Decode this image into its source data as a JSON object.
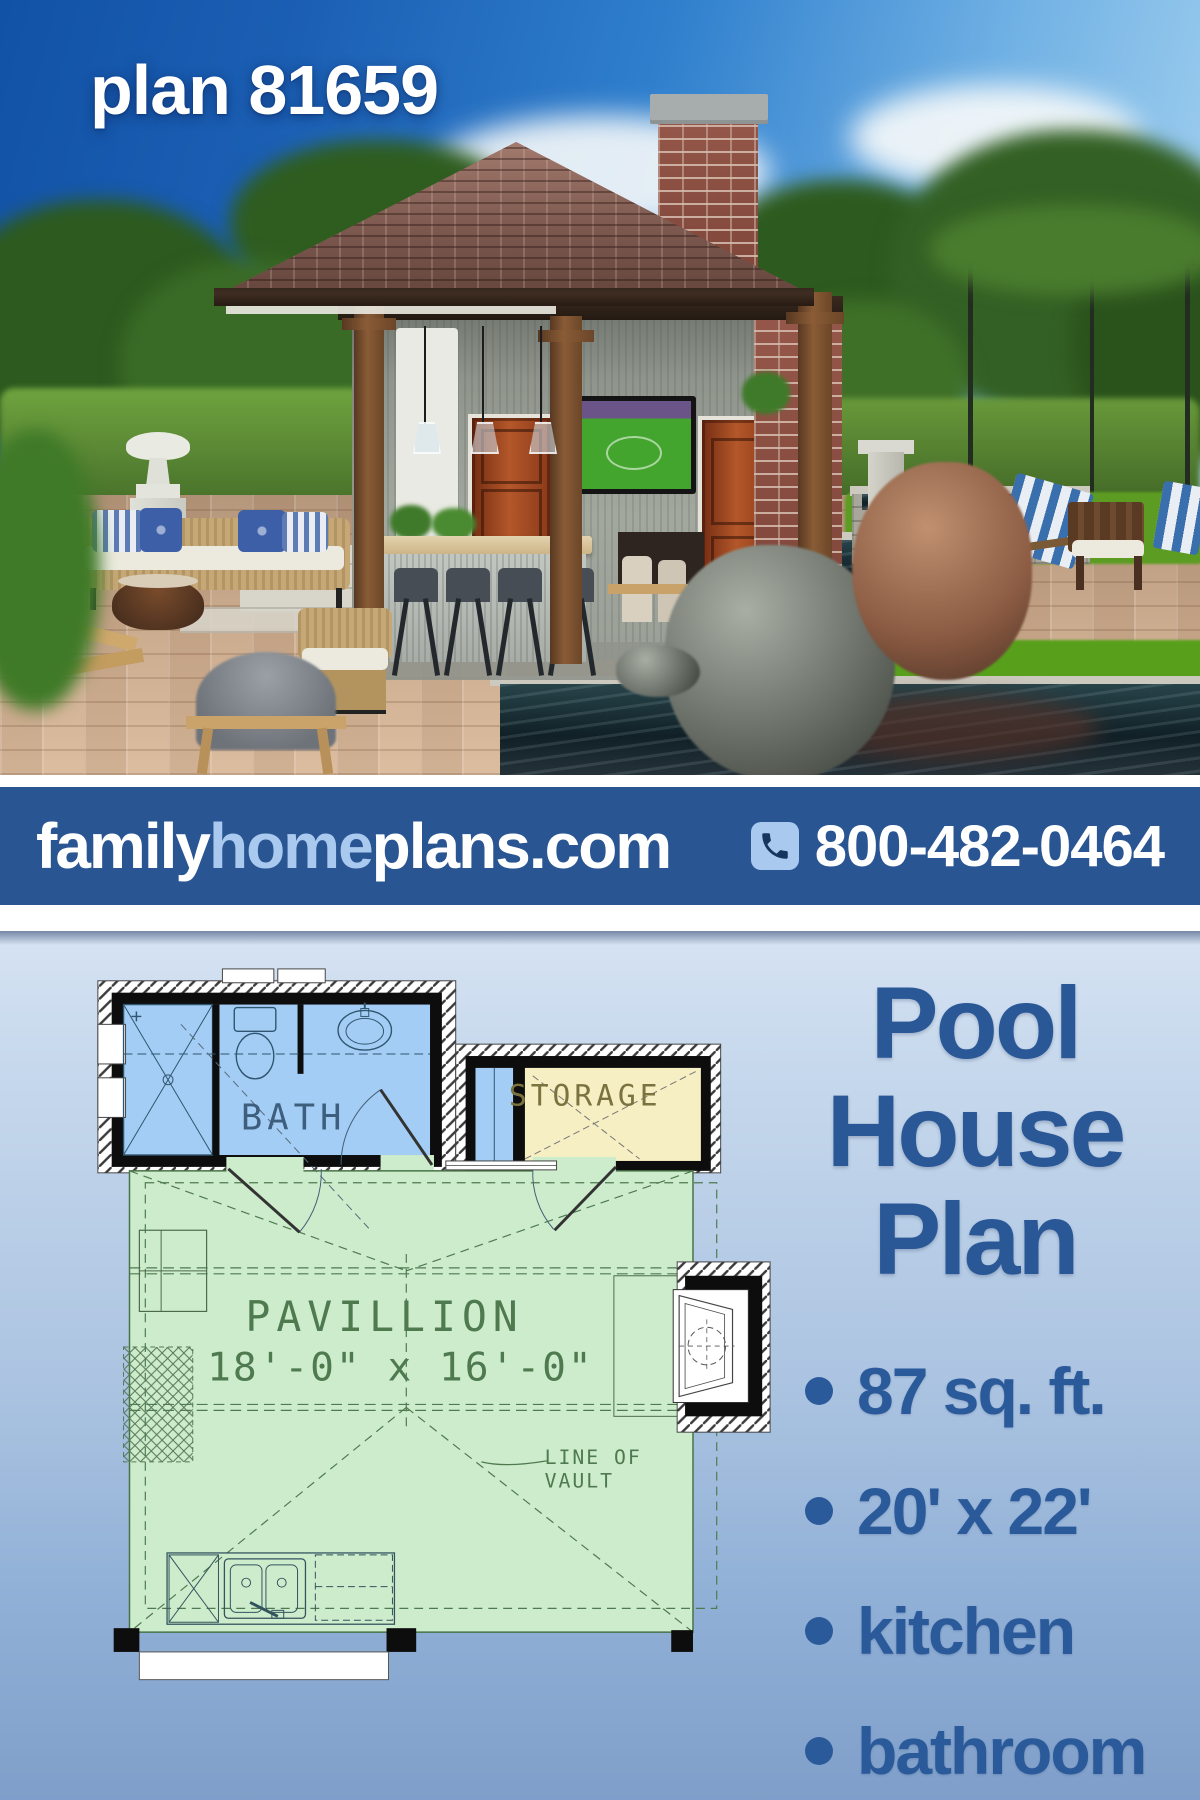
{
  "photo": {
    "overlay_title": "plan 81659"
  },
  "banner": {
    "brand_family": "family",
    "brand_home": "home",
    "brand_plans": "plans.com",
    "phone": "800-482-0464",
    "colors": {
      "background": "#2a5593",
      "brand_highlight": "#a9c9ef",
      "text": "#ffffff",
      "phone_badge": "#a9c9ef"
    }
  },
  "floor_plan": {
    "labels": {
      "bath": "BATH",
      "storage": "STORAGE",
      "pavilion": "PAVILLION",
      "pavilion_dimensions": "18'-0\" x 16'-0\"",
      "vault_note_line1": "LINE OF",
      "vault_note_line2": "VAULT"
    },
    "colors": {
      "bath_fill": "#a3cdf4",
      "storage_fill": "#f6efc3",
      "pavilion_fill": "#cdeccb",
      "wall": "#0d0d0d",
      "plan_line": "#4f7a50"
    }
  },
  "details": {
    "title_lines": [
      "Pool",
      "House",
      "Plan"
    ],
    "features": [
      "87 sq. ft.",
      "20' x 22'",
      "kitchen",
      "bathroom"
    ],
    "colors": {
      "heading": "#2a5796",
      "text": "#2b5a9b"
    }
  }
}
